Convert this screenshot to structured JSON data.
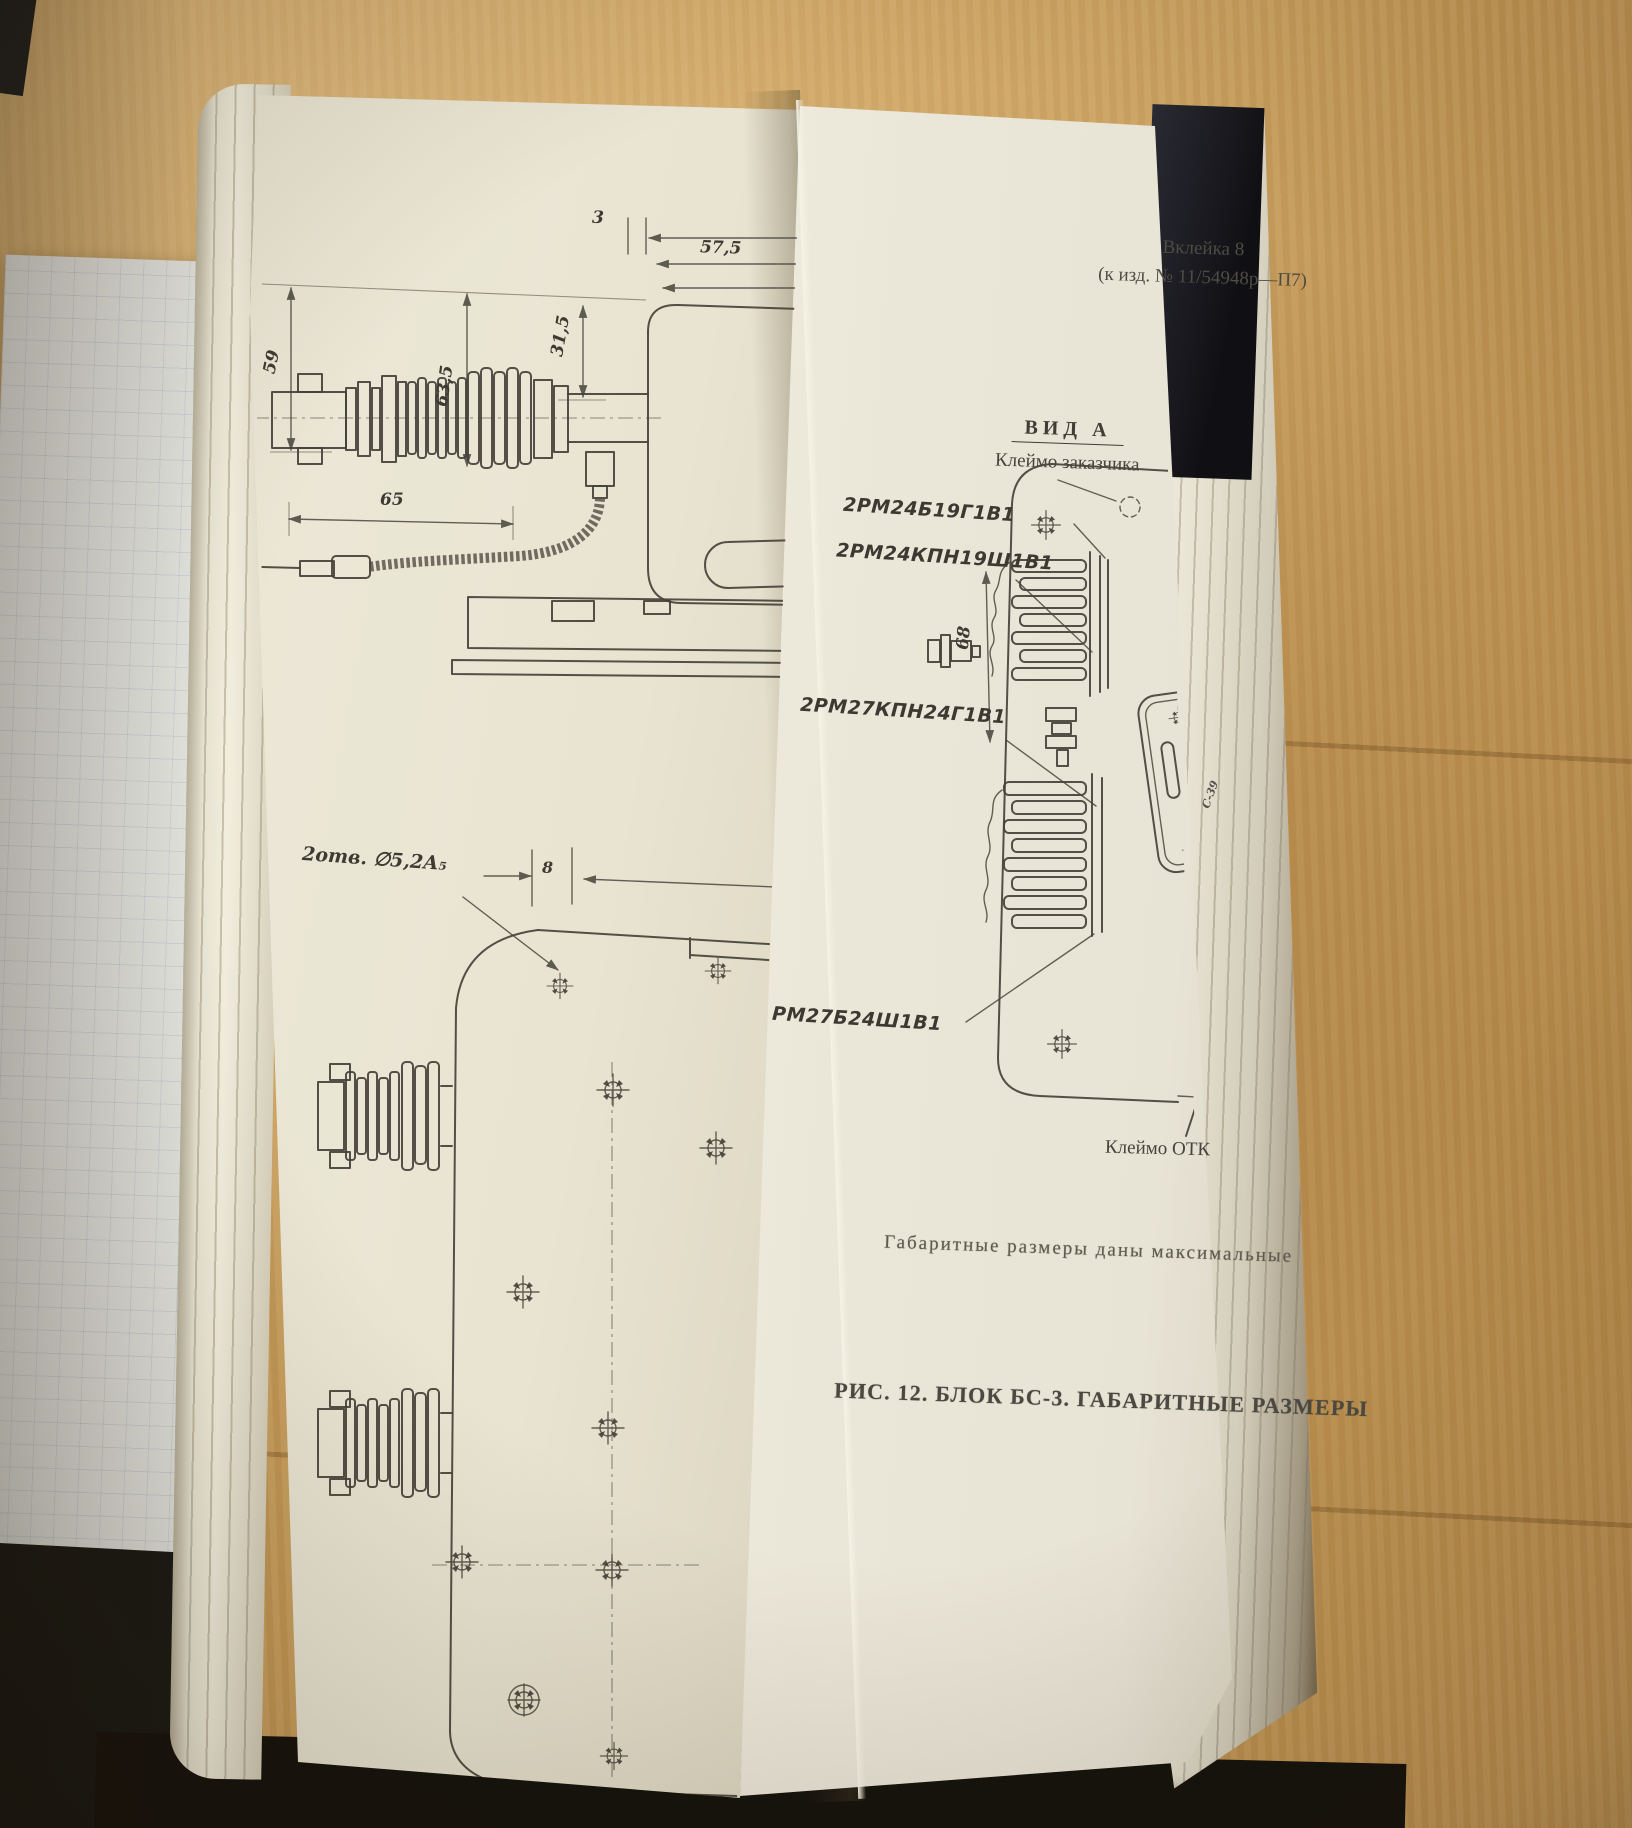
{
  "scene": {
    "description": "Photograph of an open Soviet technical manual lying on a wooden desk, showing a fold-out engineering drawing of unit BS-3 with overall dimensions",
    "wood_color": "#c69b59",
    "page_color": "#e9e4d2",
    "insert_color": "#eae6d8",
    "cover_color": "#14110d",
    "ink_color": "#45423a"
  },
  "insert": {
    "header_line1": "Вклейка 8",
    "header_line2": "(к изд. № 11/54948р—П7)",
    "view_title": "ВИД А",
    "label_customer_stamp": "Клеймо заказчика",
    "label_otk_stamp": "Клеймо ОТК",
    "connector_labels": [
      "2РМ24Б19Г1В1",
      "2РМ24КПН19Ш1В1",
      "2РМ27КПН24Г1В1",
      "РМ27Б24Ш1В1"
    ],
    "dim_68": "68",
    "plate_marking": "С-39",
    "note": "Габаритные размеры даны максимальные",
    "caption": "РИС. 12. БЛОК БС-3. ГАБАРИТНЫЕ РАЗМЕРЫ"
  },
  "left_page": {
    "dim_3": "3",
    "dim_57_5": "57,5",
    "dim_31_5": "31,5",
    "dim_63_5": "63,5",
    "dim_59": "59",
    "dim_65": "65",
    "dim_8": "8",
    "holes_label": "2отв. ∅5,2А₅"
  }
}
